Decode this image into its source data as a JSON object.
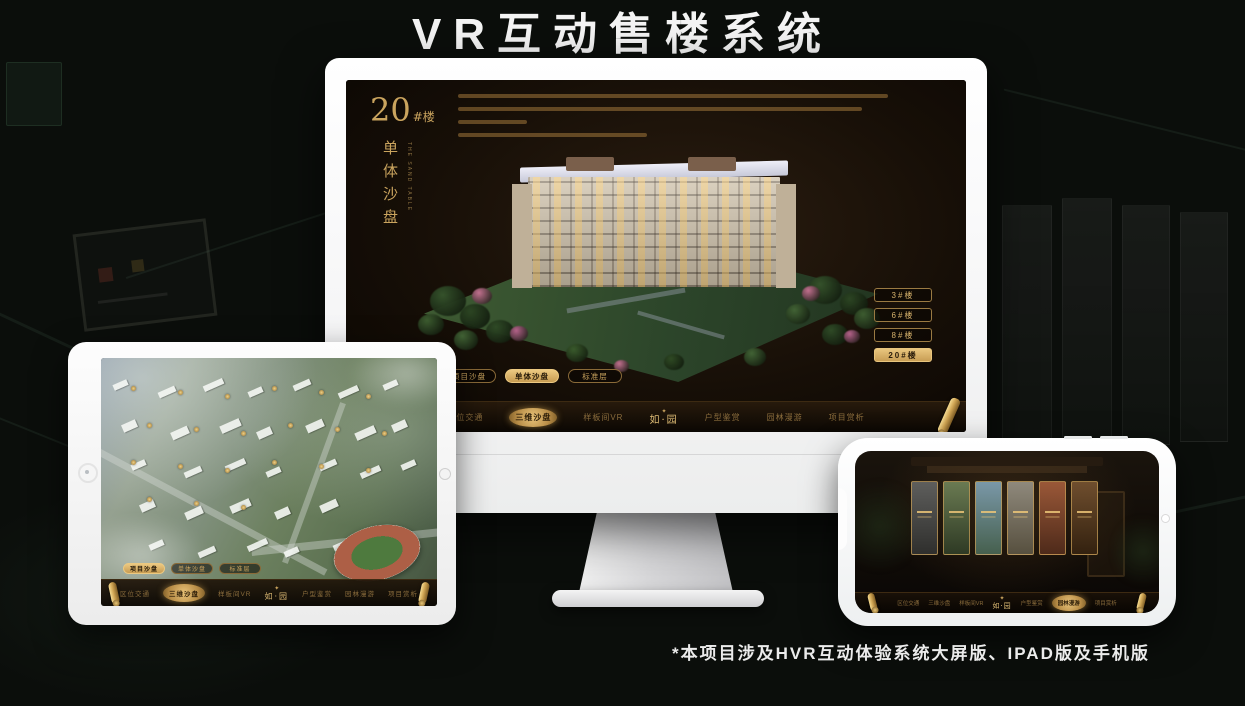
{
  "page": {
    "title": "VR互动售楼系统",
    "footnote": "*本项目涉及HVR互动体验系统大屏版、IPAD版及手机版"
  },
  "colors": {
    "gold": "#d4af6a",
    "gold_dark": "#a8834a",
    "screen_bg": "#1c130a",
    "active_pill_bg": "#e9c67e",
    "device_white": "#ffffff"
  },
  "nav": {
    "logo": "如·园",
    "logo_mark": "seal-emblem-icon",
    "items": [
      "区位交通",
      "三维沙盘",
      "样板间VR",
      "户型鉴赏",
      "园林漫游",
      "项目赏析"
    ]
  },
  "desktop": {
    "floor_no": "20",
    "floor_suffix": "#楼",
    "floor_sub": "单体沙盘",
    "floor_sub_en": "THE SAND TABLE",
    "floor_buttons": [
      {
        "label": "3#楼",
        "active": false
      },
      {
        "label": "6#楼",
        "active": false
      },
      {
        "label": "8#楼",
        "active": false
      },
      {
        "label": "20#楼",
        "active": true
      }
    ],
    "view_tabs": [
      {
        "label": "项目沙盘",
        "active": false
      },
      {
        "label": "单体沙盘",
        "active": true
      },
      {
        "label": "标准层",
        "active": false
      }
    ],
    "active_nav": "三维沙盘"
  },
  "tablet": {
    "view_tabs": [
      {
        "label": "项目沙盘",
        "active": true
      },
      {
        "label": "单体沙盘",
        "active": false
      },
      {
        "label": "标准层",
        "active": false
      }
    ],
    "active_nav": "三维沙盘"
  },
  "phone": {
    "active_nav": "园林漫游",
    "gallery_count": 6
  }
}
